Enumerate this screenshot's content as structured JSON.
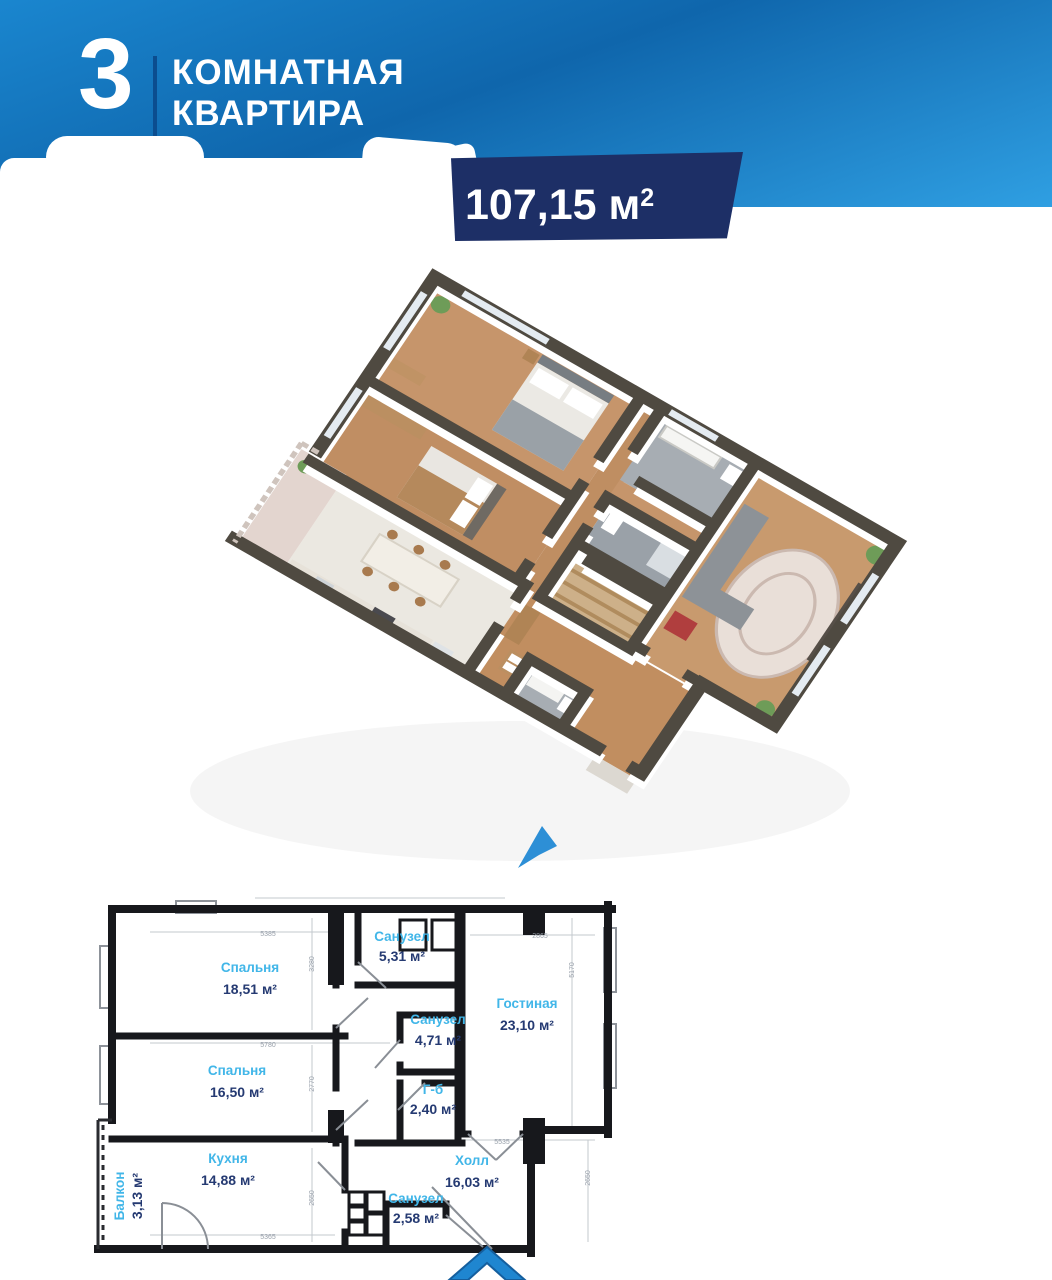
{
  "header": {
    "rooms_count": "3",
    "title_line1": "КОМНАТНАЯ",
    "title_line2": "КВАРТИРА",
    "area_value": "107,15 м",
    "area_sup": "2"
  },
  "colors": {
    "band_blue_light": "#2f9fe2",
    "band_blue_dark": "#0f66ac",
    "badge_navy": "#1d2f66",
    "room_name_blue": "#41b6e8",
    "room_area_navy": "#253a72",
    "wall_black": "#17181c",
    "iso_wall_top": "#4f4a41",
    "wood_floor": "#c6956b",
    "tile_gray": "#a7adb3",
    "arrow_blue": "#1f86d0"
  },
  "plan3d": {
    "description": "isometric 3d render of apartment",
    "direction_arrow_icon": "cursor-arrow"
  },
  "plan2d": {
    "rooms": [
      {
        "name": "Спальня",
        "area": "18,51 м²"
      },
      {
        "name": "Спальня",
        "area": "16,50 м²"
      },
      {
        "name": "Санузел",
        "area": "5,31 м²"
      },
      {
        "name": "Санузел",
        "area": "4,71 м²"
      },
      {
        "name": "Г-б",
        "area": "2,40 м²"
      },
      {
        "name": "Гостиная",
        "area": "23,10 м²"
      },
      {
        "name": "Кухня",
        "area": "14,88 м²"
      },
      {
        "name": "Балкон",
        "area": "3,13 м²"
      },
      {
        "name": "Холл",
        "area": "16,03 м²"
      },
      {
        "name": "Санузел",
        "area": "2,58 м²"
      }
    ],
    "dimensions": [
      "5385",
      "3280",
      "2865",
      "5170",
      "5780",
      "2770",
      "5535",
      "2650",
      "5365",
      "2650"
    ],
    "entry_arrow_icon": "chevron-up"
  }
}
